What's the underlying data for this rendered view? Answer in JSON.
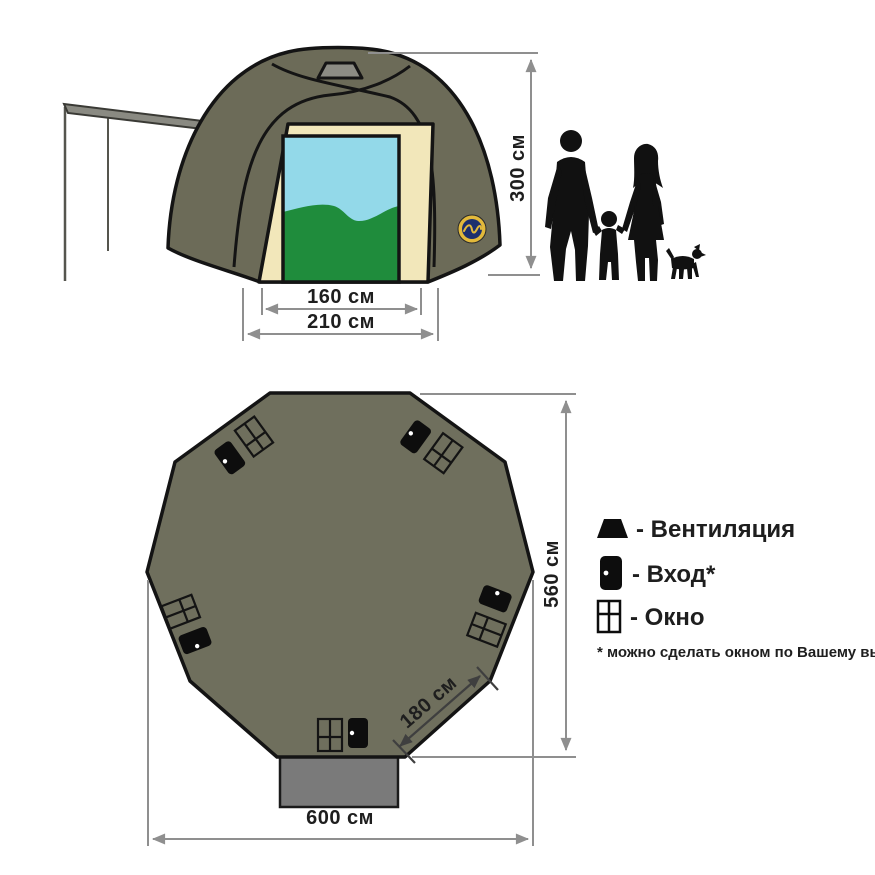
{
  "front_view": {
    "height_label": "300 см",
    "door_width_label": "160 см",
    "frame_width_label": "210 см"
  },
  "floor_plan": {
    "depth_label": "560 см",
    "width_label": "600 см",
    "panel_label": "180 см"
  },
  "legend": {
    "vent_label": "- Вентиляция",
    "entrance_label": "- Вход*",
    "window_label": "- Окно",
    "note": "* можно сделать окном по Вашему выбору"
  },
  "colors": {
    "tent_olive": "#6c6b58",
    "plan_olive": "#6f6f5d",
    "frame_cream": "#f2e7ba",
    "sky_blue": "#93d9e9",
    "hill_green": "#1f8c3c",
    "vent_gray": "#8c8c84",
    "vestibule_gray": "#7a7a7a",
    "dimension_gray": "#8f8f8f",
    "badge_navy": "#1c2f6e",
    "badge_yellow": "#e2b93b"
  }
}
